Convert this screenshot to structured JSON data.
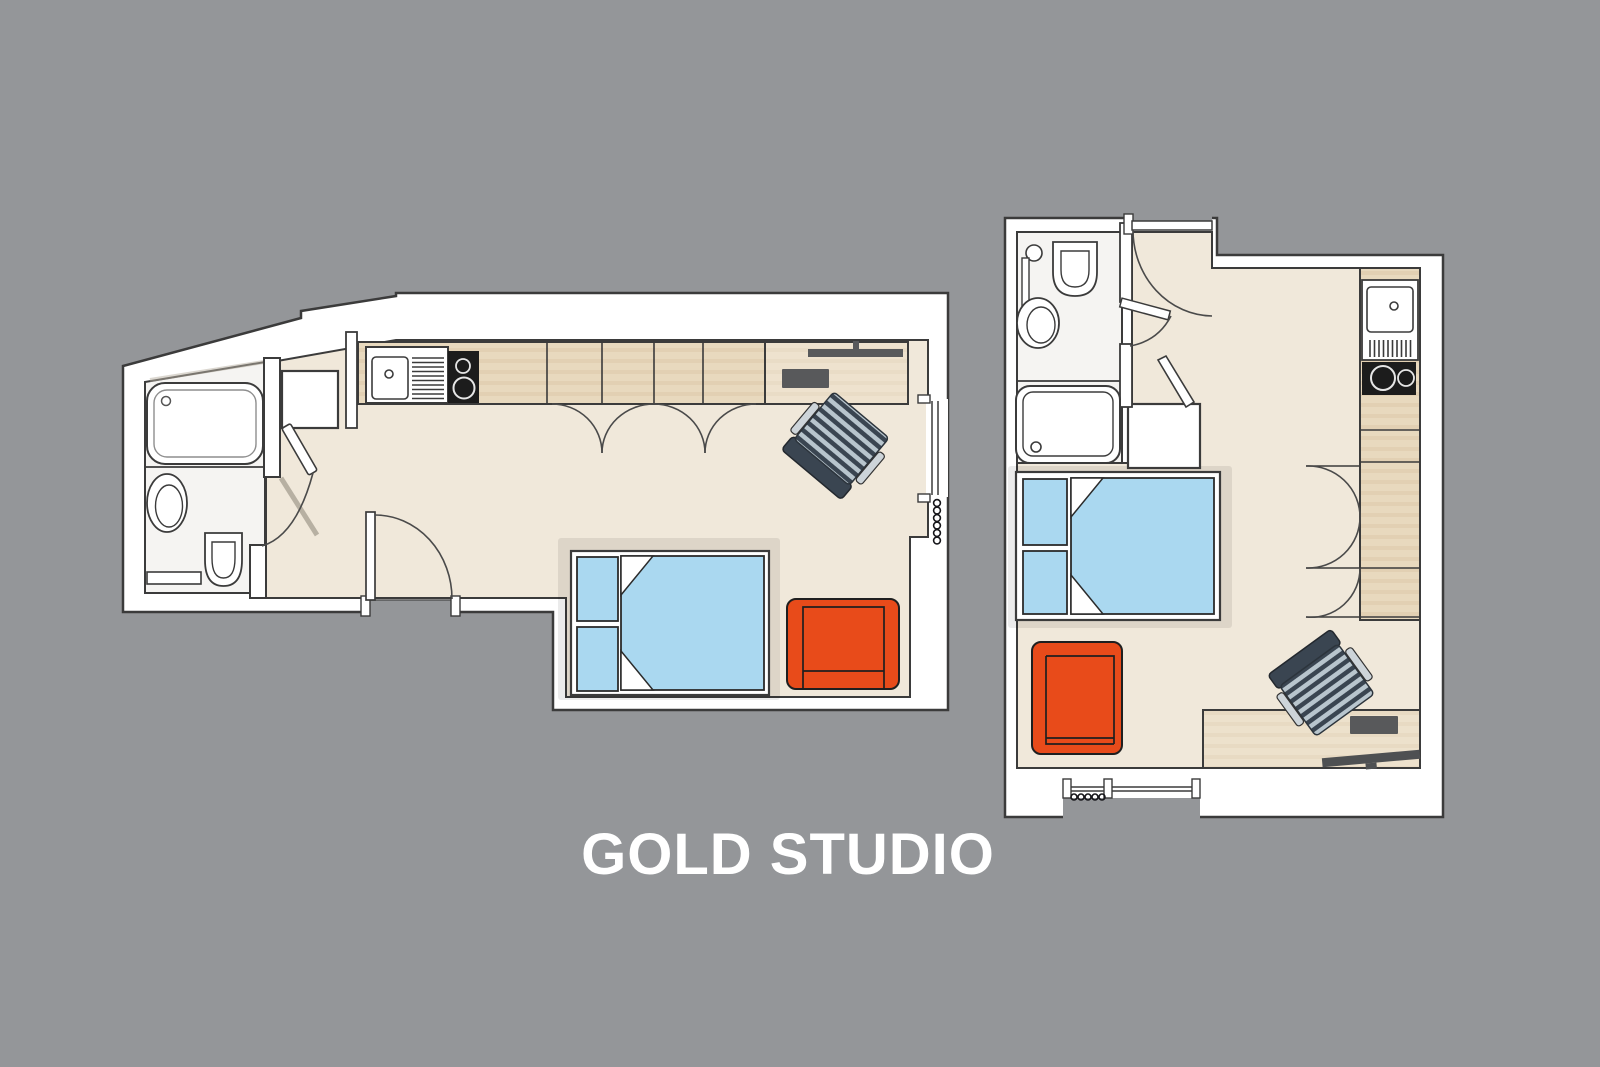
{
  "title": "GOLD STUDIO",
  "palette": {
    "bg": "#949699",
    "wall": "#ffffff",
    "line": "#3b3b3b",
    "line_soft": "#4a4a4a",
    "floor": "#f0e8da",
    "bath_floor": "#f5f4f2",
    "wood": "#e8d9be",
    "wood_stripe": "#ddcaac",
    "bed_blue": "#aad8f0",
    "bed_line": "#2b2b2b",
    "accent_orange": "#e84b1a",
    "appliance_black": "#1c1c1c",
    "chair_dark": "#3a4551",
    "chair_light": "#b8c5cd",
    "metal_gray": "#58595b",
    "door_shadow": "#a9a193",
    "title_color": "#ffffff"
  },
  "plans": [
    {
      "id": "studio-a",
      "fixtures": [
        "bathtub",
        "washbasin",
        "toilet",
        "bathroom-shelf",
        "bathroom-door",
        "closet",
        "kitchen-sink",
        "hob",
        "wardrobe-bifold-doors",
        "desk",
        "desk-chair",
        "double-bed",
        "armchair",
        "window",
        "radiator",
        "entrance-door"
      ]
    },
    {
      "id": "studio-b",
      "fixtures": [
        "toilet",
        "washbasin",
        "shower",
        "bathroom-door",
        "closet",
        "kitchen-sink",
        "hob",
        "wardrobe-bifold-doors",
        "double-bed",
        "armchair",
        "desk",
        "desk-chair",
        "window",
        "radiator",
        "entrance-door"
      ]
    }
  ]
}
